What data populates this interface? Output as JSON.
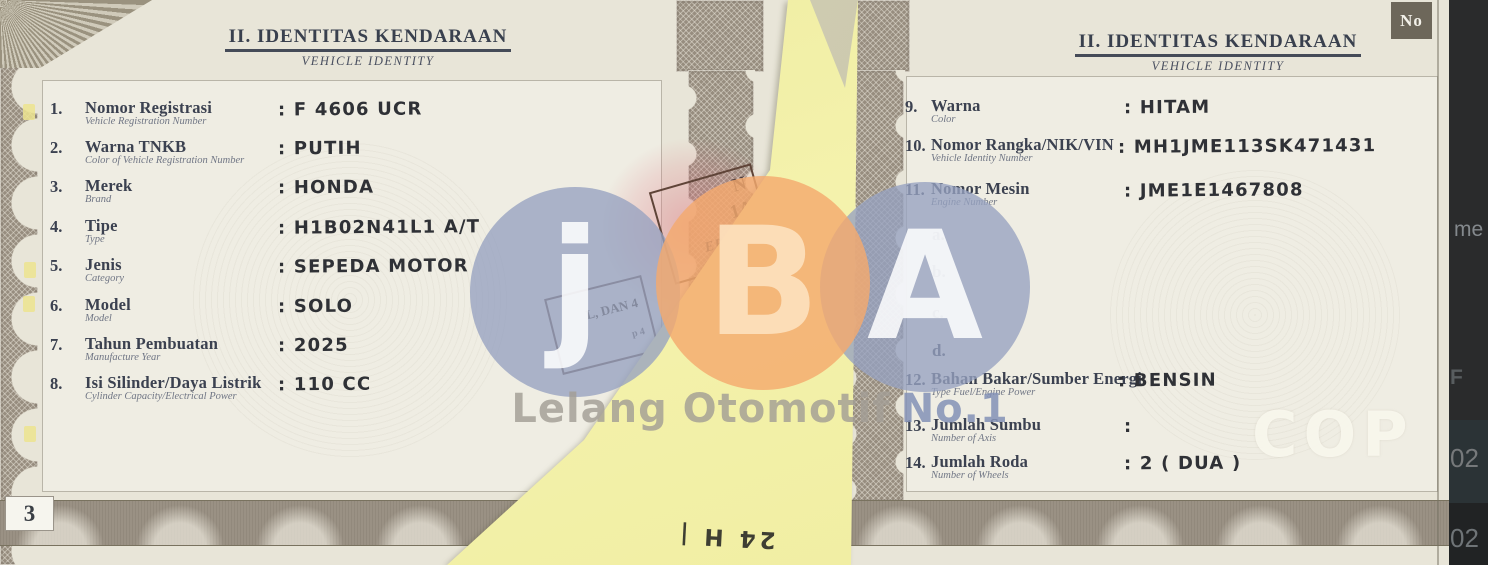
{
  "doc": {
    "left": {
      "header": {
        "title": "II. IDENTITAS KENDARAAN",
        "subtitle": "VEHICLE IDENTITY"
      },
      "page_number": "3",
      "fields": [
        {
          "num": "1.",
          "label": "Nomor Registrasi",
          "sublabel": "Vehicle Registration Number",
          "value": ": F 4606 UCR"
        },
        {
          "num": "2.",
          "label": "Warna TNKB",
          "sublabel": "Color of Vehicle Registration Number",
          "value": ": PUTIH"
        },
        {
          "num": "3.",
          "label": "Merek",
          "sublabel": "Brand",
          "value": ": HONDA"
        },
        {
          "num": "4.",
          "label": "Tipe",
          "sublabel": "Type",
          "value": ": H1B02N41L1 A/T"
        },
        {
          "num": "5.",
          "label": "Jenis",
          "sublabel": "Category",
          "value": ": SEPEDA MOTOR"
        },
        {
          "num": "6.",
          "label": "Model",
          "sublabel": "Model",
          "value": ": SOLO"
        },
        {
          "num": "7.",
          "label": "Tahun Pembuatan",
          "sublabel": "Manufacture Year",
          "value": ": 2025"
        },
        {
          "num": "8.",
          "label": "Isi Silinder/Daya Listrik",
          "sublabel": "Cylinder Capacity/Electrical Power",
          "value": ": 110 CC"
        }
      ]
    },
    "right": {
      "header": {
        "title": "II. IDENTITAS KENDARAAN",
        "subtitle": "VEHICLE IDENTITY"
      },
      "no_box": "No",
      "fields": [
        {
          "num": "9.",
          "label": "Warna",
          "sublabel": "Color",
          "value": ": HITAM"
        },
        {
          "num": "10.",
          "label": "Nomor Rangka/NIK/VIN",
          "sublabel": "Vehicle Identity Number",
          "value": ": MH1JME113SK471431"
        },
        {
          "num": "11.",
          "label": "Nomor Mesin",
          "sublabel": "Engine Number",
          "value": ": JME1E1467808"
        },
        {
          "num": "12.",
          "label": "Bahan Bakar/Sumber Energi",
          "sublabel": "Type Fuel/Engine Power",
          "value": ": BENSIN"
        },
        {
          "num": "13.",
          "label": "Jumlah Sumbu",
          "sublabel": "Number of Axis",
          "value": ":"
        },
        {
          "num": "14.",
          "label": "Jumlah Roda",
          "sublabel": "Number of Wheels",
          "value": ": 2 ( DUA )"
        }
      ],
      "letters": [
        "a.",
        "b.",
        "c.",
        "d."
      ],
      "faint_watermark": "COP"
    },
    "stamp": {
      "frag1": "N",
      "frag2": "1A",
      "frag3": "ERFEIT",
      "frag4": "L,",
      "frag5": "DAN 4",
      "frag6": "p 4",
      "bottom_mark": "24 H |"
    }
  },
  "watermark": {
    "letters": [
      "j",
      "B",
      "A"
    ],
    "tagline": "Lelang Otomotif",
    "tagline_highlight": "No.1",
    "colors": {
      "blue": "#96a2c0",
      "orange": "#f4aa6e",
      "note_yellow": "#f2efa4",
      "band_taupe": "#978d7f"
    }
  },
  "side_panel": {
    "fragments": [
      {
        "text": "me"
      },
      {
        "text": "F"
      },
      {
        "text": "02"
      },
      {
        "text": "02"
      }
    ]
  }
}
